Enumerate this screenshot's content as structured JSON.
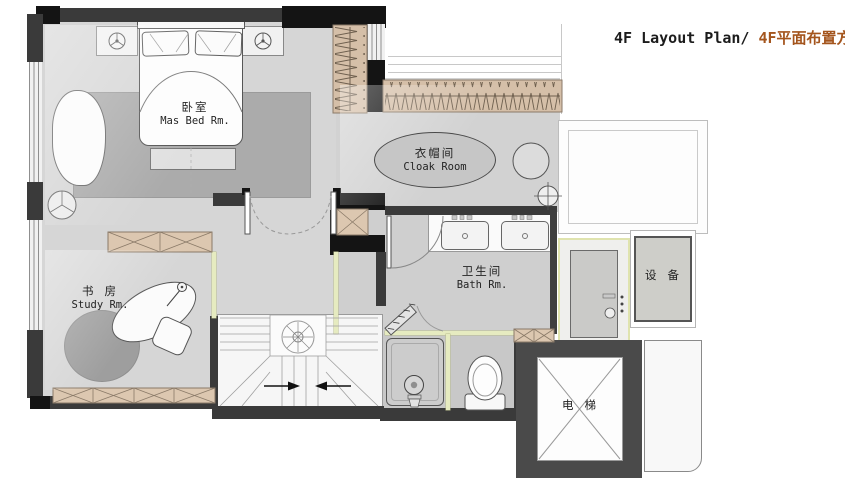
{
  "title": {
    "en": "4F Layout Plan/ ",
    "zh": "4F平面布置方案"
  },
  "rooms": {
    "master_bedroom": {
      "zh": "卧室",
      "en": "Mas Bed Rm."
    },
    "cloak_room": {
      "zh": "衣帽间",
      "en": "Cloak Room"
    },
    "study_room": {
      "zh": "书 房",
      "en": "Study Rm."
    },
    "bathroom": {
      "zh": "卫生间",
      "en": "Bath Rm."
    },
    "equipment_room": {
      "zh": "设 备"
    },
    "elevator": {
      "zh": "电 梯"
    }
  },
  "colors": {
    "title_text": "#1c1c1c",
    "title_accent": "#a4551d",
    "wall_dark": "#3a3a3a",
    "wall_black": "#141414",
    "floor_gray": "#d6d6d6",
    "rug_gray": "#ababab",
    "wood_cabinet": "#d5bfa8",
    "glass_partition": "#e6ebc0",
    "elevator_wall": "#4a4a4a"
  }
}
